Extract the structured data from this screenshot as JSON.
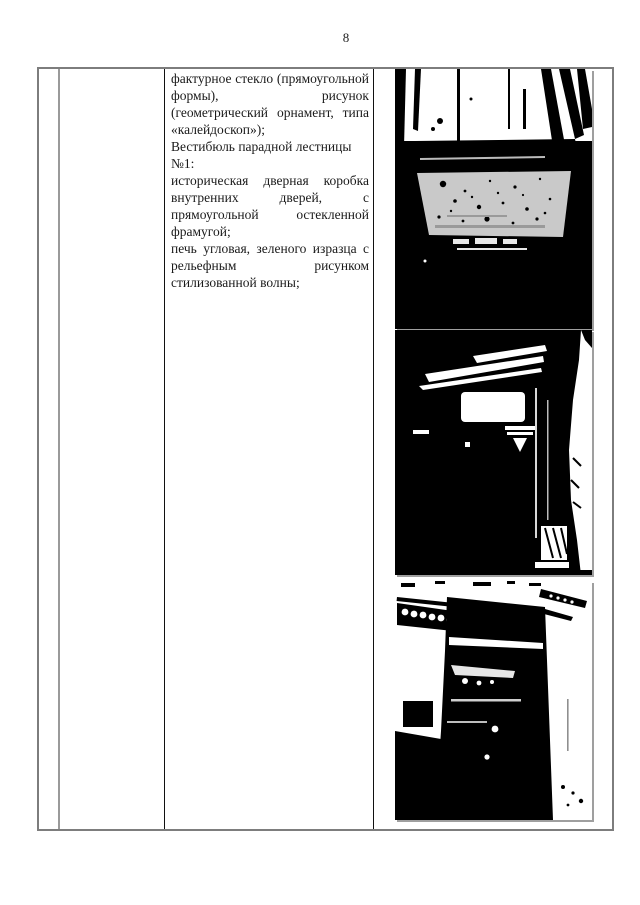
{
  "page": {
    "number": "8"
  },
  "content": {
    "para1": "фактурное стекло (прямоугольной формы), рисунок (геометрический орнамент, типа «калейдоскоп»);",
    "para2_title": "Вестибюль парадной лестницы №1:",
    "para2_body": "историческая дверная коробка внутренних дверей, с прямоугольной остекленной фрамугой;",
    "para3": "печь угловая, зеленого изразца с рельефным рисунком стилизованной волны;"
  },
  "photos": [
    {
      "name": "textured-glass-window-photo",
      "alt": "Окно с фактурным стеклом и отопительный прибор под ним"
    },
    {
      "name": "vestibule-door-frame-photo",
      "alt": "Историческая дверная коробка внутренних дверей с остекленной фрамугой"
    },
    {
      "name": "corner-stove-photo",
      "alt": "Печь угловая зеленого изразца с рельефным рисунком"
    }
  ],
  "colors": {
    "table_outer_border": "#7d7d7d",
    "table_inner_divider": "#111111",
    "photo_black": "#000000",
    "paper": "#ffffff"
  }
}
